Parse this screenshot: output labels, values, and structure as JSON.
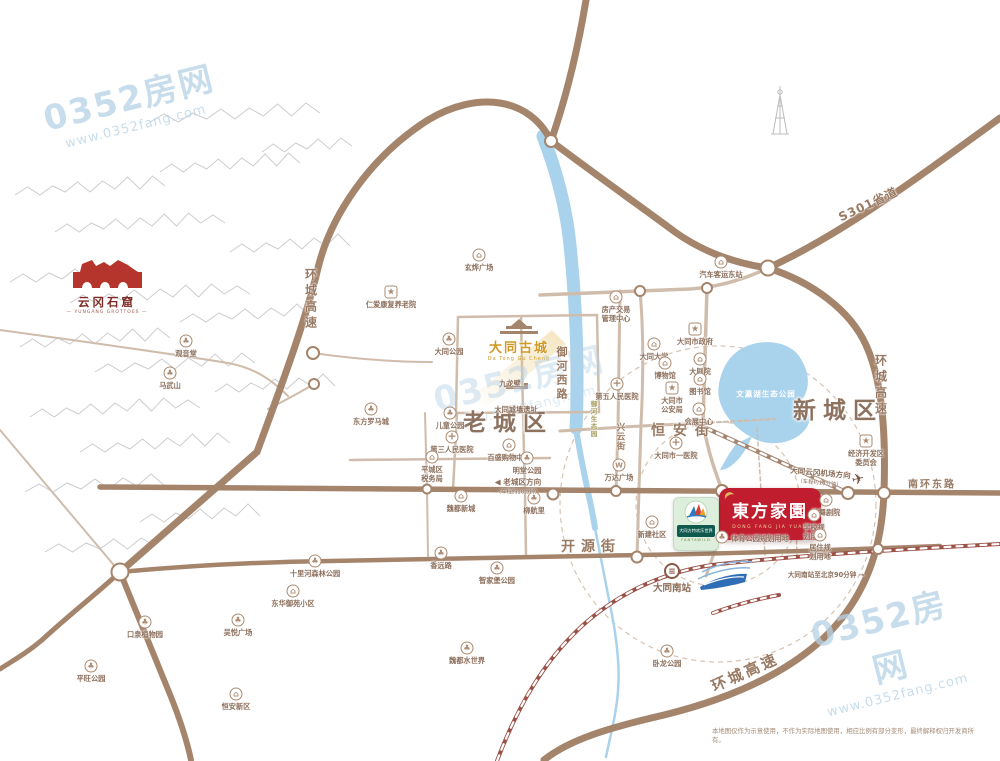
{
  "watermark": {
    "brand": "0352房网",
    "url": "www.0352fang.com"
  },
  "watermarks": [
    {
      "x": 130,
      "y": 103,
      "opacity": 0.75
    },
    {
      "x": 520,
      "y": 384,
      "opacity": 0.45
    },
    {
      "x": 886,
      "y": 648,
      "opacity": 0.75
    }
  ],
  "logos": {
    "yungang": {
      "title": "云冈石窟",
      "subtitle": "— YUNGANG GROTTOES —"
    },
    "gucheng": {
      "title": "大同古城",
      "pinyin": "Da Tong Gu Cheng"
    },
    "project": {
      "name": "東方家園",
      "pinyin": "DONG FANG JIA YUAN",
      "color": "#c01e2e"
    },
    "fantawild": {
      "name": "大同方特欢乐世界",
      "en": "FANTAWILD"
    }
  },
  "lake": {
    "label": "文瀛湖生态公园"
  },
  "district_labels": [
    {
      "text": "老城区",
      "x": 508,
      "y": 420,
      "size": 23,
      "ls": 7
    },
    {
      "text": "新城区",
      "x": 838,
      "y": 408,
      "size": 23,
      "ls": 7
    }
  ],
  "street_labels": [
    {
      "text": "恒安街",
      "x": 684,
      "y": 430,
      "size": 14,
      "ls": 8
    },
    {
      "text": "开源街",
      "x": 591,
      "y": 546,
      "size": 14,
      "ls": 6
    },
    {
      "text": "南环东路",
      "x": 932,
      "y": 483,
      "size": 10,
      "ls": 2
    },
    {
      "text": "S301省道",
      "x": 868,
      "y": 204,
      "size": 12,
      "rot": -25,
      "ls": 1
    },
    {
      "text": "环城高速",
      "x": 311,
      "y": 300,
      "size": 12,
      "vert": true,
      "ls": 4
    },
    {
      "text": "环城高速",
      "x": 881,
      "y": 386,
      "size": 12,
      "vert": true,
      "ls": 4
    },
    {
      "text": "环城高速",
      "x": 745,
      "y": 672,
      "size": 15,
      "rot": -24,
      "ls": 3
    },
    {
      "text": "御河西路",
      "x": 561,
      "y": 374,
      "size": 11,
      "vert": true,
      "ls": 3
    },
    {
      "text": "兴云街",
      "x": 620,
      "y": 437,
      "size": 8.5,
      "vert": true,
      "ls": 1
    },
    {
      "text": "御河生态园",
      "x": 593,
      "y": 419,
      "size": 6.5,
      "vert": true,
      "ls": 1,
      "color": "#a8a060"
    }
  ],
  "icon_glyphs": {
    "park": "♣",
    "building": "⌂",
    "star": "★",
    "cross": "+",
    "bus": "⌂",
    "wanda": "W",
    "rail": "≡",
    "plane": "✈"
  },
  "pois": [
    {
      "label": "观音堂",
      "icon": "park",
      "x": 186,
      "y": 341
    },
    {
      "label": "马武山",
      "icon": "park",
      "x": 170,
      "y": 373
    },
    {
      "label": "仁爱康复养老院",
      "icon": "star",
      "x": 391,
      "y": 292
    },
    {
      "label": "玄烨广场",
      "icon": "building",
      "x": 479,
      "y": 255
    },
    {
      "label": "大同公园",
      "icon": "park",
      "x": 449,
      "y": 339
    },
    {
      "label": "儿童公园",
      "icon": "park",
      "x": 450,
      "y": 413
    },
    {
      "label": "东方罗马城",
      "icon": "park",
      "x": 371,
      "y": 409
    },
    {
      "label": "九龙壁",
      "icon": "text",
      "x": 510,
      "y": 371
    },
    {
      "label": "大同城墙遗址",
      "icon": "text",
      "x": 516,
      "y": 397
    },
    {
      "label": "第五人民医院",
      "icon": "cross",
      "x": 617,
      "y": 384
    },
    {
      "label": "第三人民医院",
      "icon": "cross",
      "x": 452,
      "y": 437
    },
    {
      "label": "百盛购物中心",
      "icon": "building",
      "x": 509,
      "y": 445
    },
    {
      "label": "平城区\n税务局",
      "icon": "building",
      "x": 432,
      "y": 457
    },
    {
      "label": "明堂公园",
      "icon": "park",
      "x": 527,
      "y": 458
    },
    {
      "label": "魏都新城",
      "icon": "building",
      "x": 461,
      "y": 496
    },
    {
      "label": "柳航里",
      "icon": "park",
      "x": 534,
      "y": 498
    },
    {
      "label": "万达广场",
      "icon": "wanda",
      "x": 619,
      "y": 465
    },
    {
      "label": "会展中心",
      "icon": "building",
      "x": 699,
      "y": 409
    },
    {
      "label": "大同市政府",
      "icon": "star",
      "x": 695,
      "y": 329
    },
    {
      "label": "大同大学",
      "icon": "building",
      "x": 654,
      "y": 344
    },
    {
      "label": "博物馆",
      "icon": "building",
      "x": 665,
      "y": 363
    },
    {
      "label": "大剧院",
      "icon": "building",
      "x": 700,
      "y": 359
    },
    {
      "label": "图书馆",
      "icon": "building",
      "x": 700,
      "y": 379
    },
    {
      "label": "大同市\n公安局",
      "icon": "star",
      "x": 672,
      "y": 388
    },
    {
      "label": "房产交易\n管理中心",
      "icon": "building",
      "x": 616,
      "y": 297
    },
    {
      "label": "汽车客运东站",
      "icon": "bus",
      "x": 721,
      "y": 262
    },
    {
      "label": "大同市一医院",
      "icon": "cross",
      "x": 676,
      "y": 443
    },
    {
      "label": "经济开发区\n委员会",
      "icon": "star",
      "x": 866,
      "y": 441
    },
    {
      "label": "歌舞剧院",
      "icon": "building",
      "x": 826,
      "y": 500
    },
    {
      "label": "学校规\n划用地",
      "icon": "building",
      "x": 814,
      "y": 515
    },
    {
      "label": "居住规\n划用地",
      "icon": "building",
      "x": 820,
      "y": 535
    },
    {
      "label": "体育公园规划用地",
      "icon": "park",
      "x": 722,
      "y": 537,
      "lx": 760,
      "ly": 534
    },
    {
      "label": "新建社区",
      "icon": "building",
      "x": 652,
      "y": 522
    },
    {
      "label": "香远路",
      "icon": "park",
      "x": 441,
      "y": 553
    },
    {
      "label": "智家堡公园",
      "icon": "park",
      "x": 497,
      "y": 568
    },
    {
      "label": "魏都水世界",
      "icon": "park",
      "x": 467,
      "y": 648
    },
    {
      "label": "卧龙公园",
      "icon": "park",
      "x": 667,
      "y": 651
    },
    {
      "label": "十里河森林公园",
      "icon": "park",
      "x": 315,
      "y": 561
    },
    {
      "label": "东华御苑小区",
      "icon": "building",
      "x": 293,
      "y": 591
    },
    {
      "label": "口泉植物园",
      "icon": "park",
      "x": 145,
      "y": 622
    },
    {
      "label": "吴悦广场",
      "icon": "park",
      "x": 238,
      "y": 620
    },
    {
      "label": "平旺公园",
      "icon": "park",
      "x": 91,
      "y": 666
    },
    {
      "label": "恒安新区",
      "icon": "building",
      "x": 236,
      "y": 694
    },
    {
      "label": "大同南站",
      "icon": "rail",
      "x": 672,
      "y": 571,
      "ly": 583,
      "size": 9.5
    },
    {
      "label": "",
      "icon": "plane",
      "x": 858,
      "y": 479
    }
  ],
  "notes": [
    {
      "text": "◀ 老城区方向",
      "sub": "（车程约10分钟）",
      "x": 518,
      "y": 486
    },
    {
      "text": "大同云冈机场方向",
      "sub": "（车程约10分钟）",
      "x": 820,
      "y": 477,
      "rot": 5
    },
    {
      "text": "大同南站至北京90分钟 →",
      "x": 826,
      "y": 574,
      "small": true
    }
  ],
  "disclaimer": "本地图仅作为示意使用，不作为实际地图使用，相应比例有部分变形，最终解释权归开发商所有。"
}
